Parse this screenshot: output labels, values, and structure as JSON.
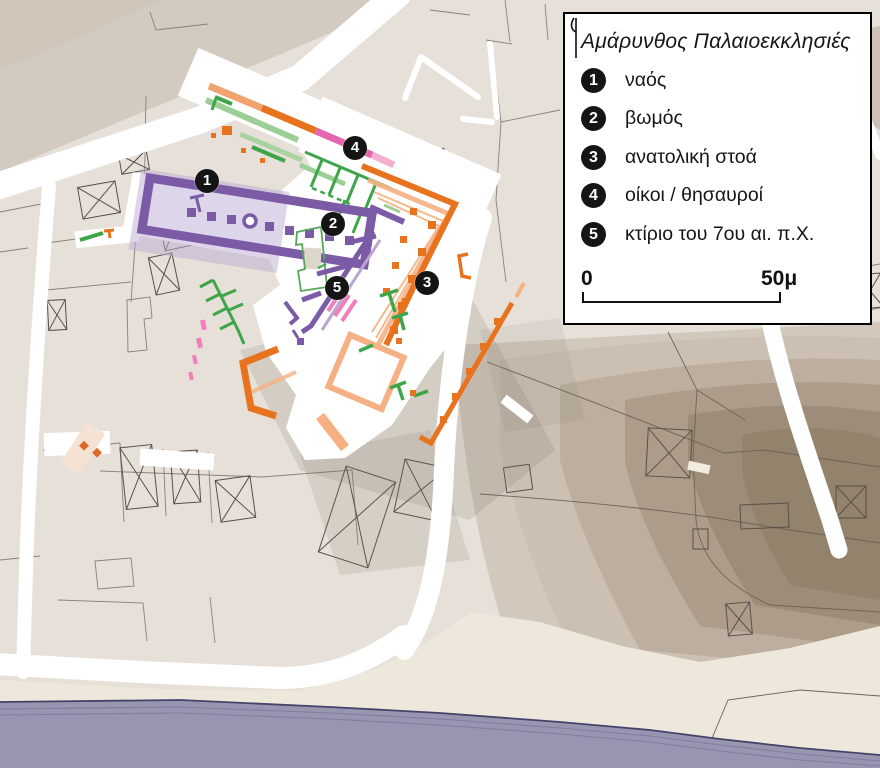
{
  "legend": {
    "title": "Αμάρυνθος Παλαιοεκκλησιές",
    "items": [
      {
        "number": "1",
        "label": "ναός"
      },
      {
        "number": "2",
        "label": "βωμός"
      },
      {
        "number": "3",
        "label": "ανατολική στοά"
      },
      {
        "number": "4",
        "label": "οίκοι / θησαυροί"
      },
      {
        "number": "5",
        "label": "κτίριο του 7ου αι. π.Χ."
      }
    ],
    "scale": {
      "start": "0",
      "end": "50μ"
    }
  },
  "map": {
    "badges": [
      {
        "number": "1"
      },
      {
        "number": "2"
      },
      {
        "number": "3"
      },
      {
        "number": "4"
      },
      {
        "number": "5"
      }
    ]
  },
  "colors": {
    "background": "#E6E0D8",
    "upper_parcels": "#D4CBC0",
    "road": "#FFFFFF",
    "parcel_line": "#8A8177",
    "building_line": "#57504A",
    "temple_purple": "#7B5AA6",
    "temple_light": "#BCABD4",
    "stoa_orange": "#E8731E",
    "stoa_light": "#F5B183",
    "green": "#3FA54B",
    "green_light": "#9CCF95",
    "pink": "#E366AE",
    "pink_light": "#F2A7CC",
    "church_cream": "#F6E2D2",
    "hill_band_1": "#CBC0B2",
    "hill_band_2": "#BCAF9F",
    "hill_band_3": "#AC9C89",
    "hill_band_4": "#9D8C77",
    "beach": "#EDE7DC",
    "sea": "#9795AF",
    "sea_line": "#45436A",
    "badge": "#151515"
  }
}
